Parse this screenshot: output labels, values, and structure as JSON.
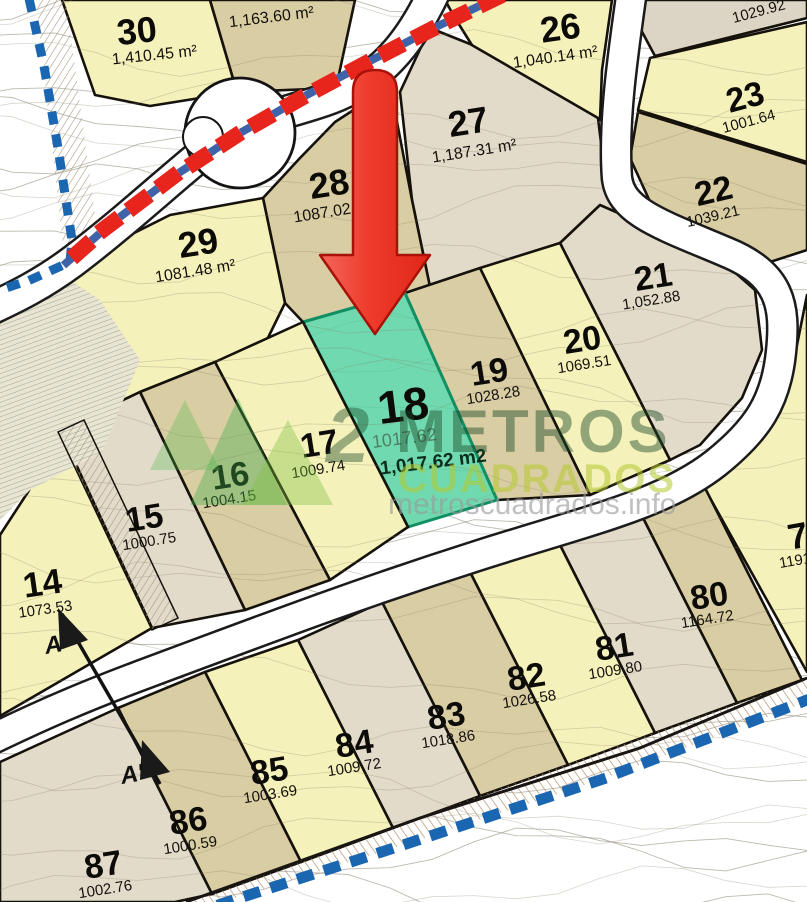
{
  "title": "Land subdivision plan with highlighted parcel 18",
  "watermark": {
    "logo_digit": "2",
    "line1": "METROS",
    "line2": "CUADRADOS",
    "url": "metroscuadrados.info",
    "color_dark_green": "#1c4a28",
    "color_lime": "#b5c92f",
    "color_gray": "#9b9b9b"
  },
  "highlight": {
    "lot_number": "18",
    "area_faint": "1017.62",
    "area_label": "1,017.62 m2",
    "fill": "#57d2a1",
    "border": "#0f8f63"
  },
  "section": {
    "start_label": "A",
    "end_label": "A'",
    "line": [
      [
        62,
        614
      ],
      [
        160,
        784
      ]
    ],
    "start_pos": [
      46,
      654
    ],
    "end_pos": [
      122,
      784
    ]
  },
  "palette": {
    "y": "#f5f1bb",
    "t": "#d9cda4",
    "g": "#e2dbca",
    "gt": "#dcd5c5",
    "road_casing": "#1b1b1b",
    "parcel_line": "#15110b",
    "boundary_blue": "#1b66b1",
    "axis_red": "#e8251c",
    "axis_blue": "#3f63a9",
    "arrow_red_1": "#f4675c",
    "arrow_red_2": "#e02718",
    "arrow_stroke": "#a81208"
  },
  "map": {
    "lots": [
      {
        "id": "30",
        "number": "30",
        "area": "1,410.45 m²",
        "fill": "y",
        "poly": [
          [
            62,
            0
          ],
          [
            210,
            0
          ],
          [
            237,
            92
          ],
          [
            200,
            98
          ],
          [
            150,
            106
          ],
          [
            95,
            95
          ]
        ],
        "num": [
          138,
          43,
          36,
          -6
        ],
        "area_pos": [
          155,
          60,
          16,
          -6
        ]
      },
      {
        "id": "u1163",
        "number": null,
        "area": "1,163.60 m²",
        "fill": "t",
        "poly": [
          [
            210,
            0
          ],
          [
            355,
            0
          ],
          [
            336,
            88
          ],
          [
            237,
            92
          ]
        ],
        "num": null,
        "area_pos": [
          272,
          22,
          16,
          -7
        ]
      },
      {
        "id": "26",
        "number": "26",
        "area": "1,040.14 m²",
        "fill": "y",
        "poly": [
          [
            445,
            0
          ],
          [
            612,
            0
          ],
          [
            602,
            70
          ],
          [
            600,
            120
          ],
          [
            480,
            58
          ],
          [
            455,
            18
          ]
        ],
        "num": [
          562,
          40,
          36,
          -8
        ],
        "area_pos": [
          556,
          62,
          16,
          -8
        ]
      },
      {
        "id": "24",
        "number": null,
        "area": "1029.92",
        "fill": "gt",
        "poly": [
          [
            643,
            0
          ],
          [
            807,
            0
          ],
          [
            807,
            18
          ],
          [
            655,
            56
          ],
          [
            640,
            28
          ]
        ],
        "num": null,
        "area_pos": [
          760,
          16,
          15,
          -15
        ]
      },
      {
        "id": "23",
        "number": "23",
        "area": "1001.64",
        "fill": "y",
        "poly": [
          [
            650,
            58
          ],
          [
            807,
            22
          ],
          [
            807,
            162
          ],
          [
            638,
            110
          ]
        ],
        "num": [
          748,
          108,
          34,
          -15
        ],
        "area_pos": [
          750,
          126,
          15,
          -15
        ]
      },
      {
        "id": "22",
        "number": "22",
        "area": "1039.21",
        "fill": "t",
        "poly": [
          [
            638,
            112
          ],
          [
            807,
            164
          ],
          [
            807,
            250
          ],
          [
            770,
            262
          ],
          [
            716,
            236
          ],
          [
            652,
            206
          ],
          [
            630,
            158
          ]
        ],
        "num": [
          716,
          202,
          34,
          -13
        ],
        "area_pos": [
          714,
          221,
          15,
          -13
        ]
      },
      {
        "id": "27",
        "number": "27",
        "area": "1,187.31 m²",
        "fill": "g",
        "poly": [
          [
            400,
            92
          ],
          [
            430,
            28
          ],
          [
            470,
            44
          ],
          [
            598,
            118
          ],
          [
            606,
            184
          ],
          [
            636,
            210
          ],
          [
            560,
            243
          ],
          [
            430,
            287
          ],
          [
            412,
            200
          ]
        ],
        "num": [
          470,
          134,
          36,
          -9
        ],
        "area_pos": [
          475,
          156,
          16,
          -9
        ]
      },
      {
        "id": "28",
        "number": "28",
        "area": "1087.02",
        "fill": "t",
        "poly": [
          [
            263,
            198
          ],
          [
            300,
            158
          ],
          [
            335,
            122
          ],
          [
            372,
            98
          ],
          [
            392,
            96
          ],
          [
            412,
            200
          ],
          [
            430,
            287
          ],
          [
            405,
            293
          ],
          [
            303,
            322
          ],
          [
            285,
            303
          ]
        ],
        "num": [
          331,
          196,
          36,
          -9
        ],
        "area_pos": [
          323,
          218,
          16,
          -9
        ]
      },
      {
        "id": "29",
        "number": "29",
        "area": "1081.48 m²",
        "fill": "y",
        "poly": [
          [
            0,
            330
          ],
          [
            100,
            250
          ],
          [
            170,
            215
          ],
          [
            263,
            198
          ],
          [
            285,
            303
          ],
          [
            262,
            350
          ],
          [
            215,
            362
          ],
          [
            140,
            392
          ],
          [
            60,
            430
          ],
          [
            0,
            470
          ]
        ],
        "num": [
          200,
          255,
          36,
          -9
        ],
        "area_pos": [
          196,
          276,
          16,
          -9
        ]
      },
      {
        "id": "21",
        "number": "21",
        "area": "1,052.88",
        "fill": "g",
        "poly": [
          [
            560,
            243
          ],
          [
            600,
            205
          ],
          [
            650,
            227
          ],
          [
            715,
            255
          ],
          [
            755,
            290
          ],
          [
            762,
            350
          ],
          [
            742,
            398
          ],
          [
            700,
            445
          ],
          [
            670,
            460
          ]
        ],
        "num": [
          655,
          288,
          34,
          -9
        ],
        "area_pos": [
          652,
          305,
          15,
          -9
        ]
      },
      {
        "id": "20",
        "number": "20",
        "area": "1069.51",
        "fill": "y",
        "poly": [
          [
            480,
            268
          ],
          [
            560,
            243
          ],
          [
            670,
            460
          ],
          [
            590,
            495
          ]
        ],
        "num": [
          584,
          351,
          34,
          -9
        ],
        "area_pos": [
          585,
          369,
          15,
          -9
        ]
      },
      {
        "id": "19",
        "number": "19",
        "area": "1028.28",
        "fill": "t",
        "poly": [
          [
            405,
            293
          ],
          [
            480,
            268
          ],
          [
            590,
            495
          ],
          [
            497,
            500
          ]
        ],
        "num": [
          491,
          383,
          34,
          -9
        ],
        "area_pos": [
          494,
          400,
          15,
          -9
        ]
      },
      {
        "id": "18",
        "number": "18",
        "area": null,
        "fill": "green",
        "poly": [
          [
            303,
            322
          ],
          [
            405,
            293
          ],
          [
            497,
            500
          ],
          [
            408,
            527
          ]
        ],
        "num": [
          405,
          421,
          46,
          -7
        ],
        "area_pos": null
      },
      {
        "id": "17",
        "number": "17",
        "area": "1009.74",
        "fill": "y",
        "poly": [
          [
            215,
            362
          ],
          [
            303,
            322
          ],
          [
            408,
            527
          ],
          [
            330,
            580
          ]
        ],
        "num": [
          321,
          455,
          34,
          -9
        ],
        "area_pos": [
          319,
          474,
          15,
          -9
        ]
      },
      {
        "id": "16",
        "number": "16",
        "area": "1004.15",
        "fill": "t",
        "poly": [
          [
            140,
            392
          ],
          [
            215,
            362
          ],
          [
            330,
            580
          ],
          [
            245,
            610
          ]
        ],
        "num": [
          232,
          487,
          34,
          -9
        ],
        "area_pos": [
          230,
          504,
          15,
          -9
        ]
      },
      {
        "id": "15",
        "number": "15",
        "area": "1000.75",
        "fill": "g",
        "poly": [
          [
            60,
            430
          ],
          [
            140,
            392
          ],
          [
            245,
            610
          ],
          [
            152,
            628
          ]
        ],
        "num": [
          146,
          529,
          34,
          -9
        ],
        "area_pos": [
          150,
          546,
          15,
          -9
        ]
      },
      {
        "id": "14",
        "number": "14",
        "area": "1073.53",
        "fill": "y",
        "poly": [
          [
            0,
            535
          ],
          [
            28,
            492
          ],
          [
            60,
            430
          ],
          [
            152,
            628
          ],
          [
            0,
            716
          ]
        ],
        "num": [
          44,
          595,
          35,
          -8
        ],
        "area_pos": [
          46,
          614,
          15,
          -8
        ]
      },
      {
        "id": "7",
        "number": "7",
        "area": "1191.",
        "fill": "y",
        "poly": [
          [
            807,
            295
          ],
          [
            807,
            672
          ],
          [
            700,
            480
          ],
          [
            742,
            460
          ],
          [
            777,
            410
          ],
          [
            796,
            350
          ]
        ],
        "num": [
          800,
          548,
          36,
          -10
        ],
        "area_pos": [
          798,
          565,
          15,
          -10
        ]
      },
      {
        "id": "80",
        "number": "80",
        "area": "1164.72",
        "fill": "t",
        "poly": [
          [
            640,
            512
          ],
          [
            700,
            478
          ],
          [
            802,
            680
          ],
          [
            737,
            703
          ]
        ],
        "num": [
          711,
          607,
          34,
          -9
        ],
        "area_pos": [
          708,
          624,
          15,
          -9
        ]
      },
      {
        "id": "81",
        "number": "81",
        "area": "1009.80",
        "fill": "g",
        "poly": [
          [
            560,
            545
          ],
          [
            640,
            512
          ],
          [
            737,
            703
          ],
          [
            655,
            733
          ]
        ],
        "num": [
          616,
          658,
          34,
          -9
        ],
        "area_pos": [
          616,
          675,
          15,
          -9
        ]
      },
      {
        "id": "82",
        "number": "82",
        "area": "1026.58",
        "fill": "y",
        "poly": [
          [
            470,
            572
          ],
          [
            560,
            545
          ],
          [
            655,
            733
          ],
          [
            568,
            765
          ]
        ],
        "num": [
          528,
          688,
          34,
          -9
        ],
        "area_pos": [
          530,
          704,
          15,
          -9
        ]
      },
      {
        "id": "83",
        "number": "83",
        "area": "1018.86",
        "fill": "t",
        "poly": [
          [
            382,
            602
          ],
          [
            470,
            572
          ],
          [
            568,
            765
          ],
          [
            480,
            796
          ]
        ],
        "num": [
          448,
          727,
          34,
          -9
        ],
        "area_pos": [
          449,
          744,
          15,
          -9
        ]
      },
      {
        "id": "84",
        "number": "84",
        "area": "1009.72",
        "fill": "g",
        "poly": [
          [
            298,
            640
          ],
          [
            382,
            602
          ],
          [
            480,
            796
          ],
          [
            393,
            828
          ]
        ],
        "num": [
          356,
          755,
          34,
          -9
        ],
        "area_pos": [
          355,
          772,
          15,
          -9
        ]
      },
      {
        "id": "85",
        "number": "85",
        "area": "1003.69",
        "fill": "y",
        "poly": [
          [
            205,
            672
          ],
          [
            298,
            640
          ],
          [
            393,
            828
          ],
          [
            301,
            862
          ]
        ],
        "num": [
          271,
          782,
          34,
          -9
        ],
        "area_pos": [
          271,
          799,
          15,
          -9
        ]
      },
      {
        "id": "86",
        "number": "86",
        "area": "1000.59",
        "fill": "t",
        "poly": [
          [
            118,
            708
          ],
          [
            205,
            672
          ],
          [
            301,
            862
          ],
          [
            212,
            894
          ]
        ],
        "num": [
          190,
          832,
          34,
          -9
        ],
        "area_pos": [
          191,
          850,
          15,
          -9
        ]
      },
      {
        "id": "87",
        "number": "87",
        "area": "1002.76",
        "fill": "g",
        "poly": [
          [
            0,
            762
          ],
          [
            118,
            708
          ],
          [
            212,
            894
          ],
          [
            175,
            902
          ],
          [
            0,
            902
          ]
        ],
        "num": [
          105,
          876,
          34,
          -9
        ],
        "area_pos": [
          106,
          894,
          15,
          -9
        ]
      }
    ],
    "boundaries": {
      "left": {
        "pts": [
          [
            28,
            -6
          ],
          [
            44,
            66
          ],
          [
            58,
            148
          ],
          [
            72,
            240
          ],
          [
            70,
            262
          ],
          [
            30,
            280
          ],
          [
            -6,
            292
          ]
        ],
        "size": [
          13,
          9
        ],
        "gap": 23
      },
      "bottom": {
        "pts": [
          [
            212,
            907
          ],
          [
            400,
            846
          ],
          [
            600,
            780
          ],
          [
            807,
            700
          ]
        ],
        "size": [
          17,
          11
        ],
        "gap": 28
      }
    },
    "road_axis": {
      "pts": [
        [
          500,
          -4
        ],
        [
          438,
          26
        ],
        [
          372,
          60
        ],
        [
          305,
          96
        ],
        [
          240,
          133
        ],
        [
          174,
          176
        ],
        [
          108,
          226
        ],
        [
          56,
          272
        ]
      ],
      "red_size": [
        26,
        16
      ],
      "red_gap": 37,
      "blue_size": [
        11,
        8
      ]
    },
    "arrow": {
      "shaft_x1": 353,
      "shaft_x2": 397,
      "shaft_top": 70,
      "shaft_base": 255,
      "head_left": 320,
      "head_right": 430,
      "apex_x": 375,
      "apex_y": 334
    }
  }
}
